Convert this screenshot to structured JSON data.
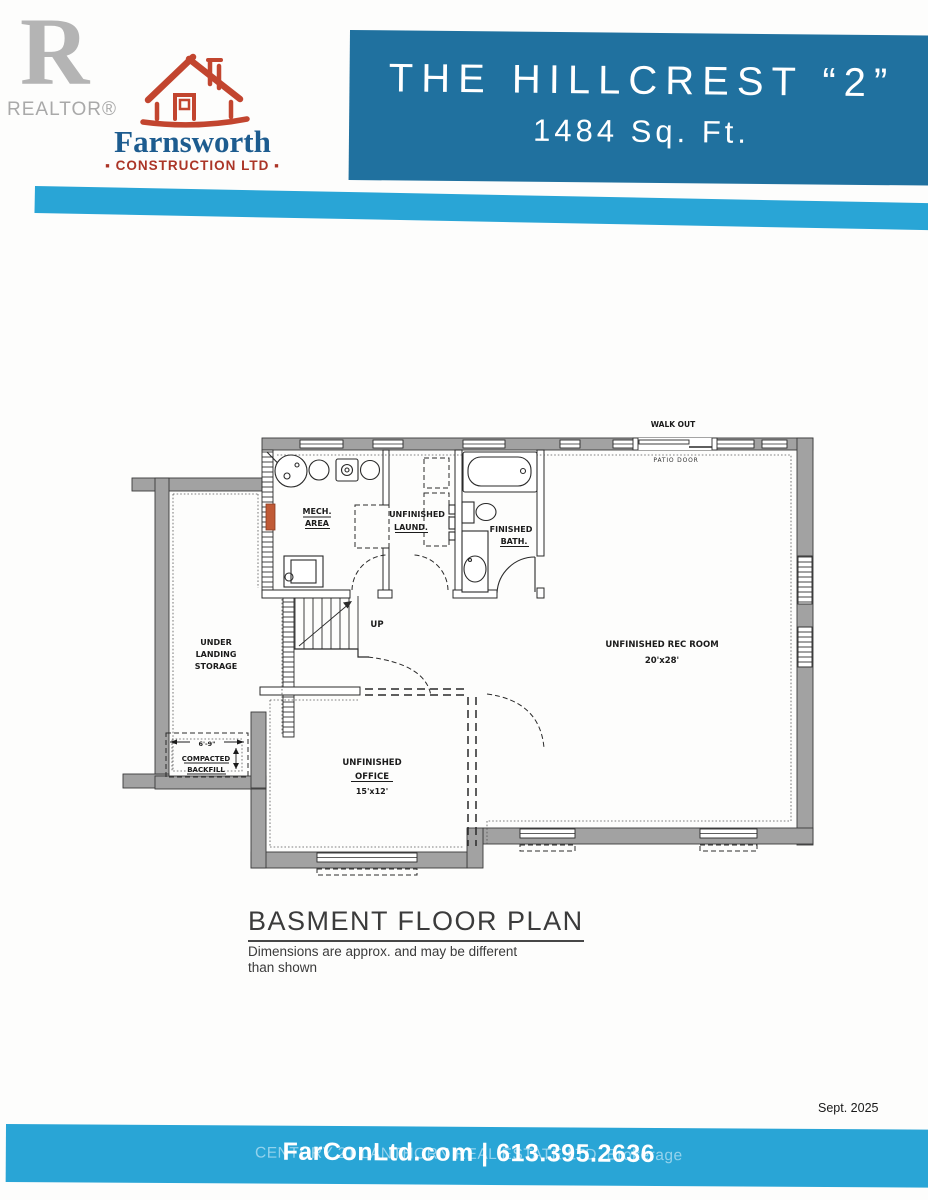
{
  "header": {
    "realtor_label": "REALTOR®",
    "realtor_letter": "R",
    "company": {
      "name": "Farnsworth",
      "subtitle": "▪ CONSTRUCTION LTD ▪"
    },
    "banner": {
      "title": "THE HILLCREST “2”",
      "subtitle": "1484 Sq. Ft."
    }
  },
  "plan": {
    "walk_out": "WALK OUT",
    "patio_door": "PATIO DOOR",
    "mech_line1": "MECH.",
    "mech_line2": "AREA",
    "laund_line1": "UNFINISHED",
    "laund_line2": "LAUND.",
    "bath_line1": "FINISHED",
    "bath_line2": "BATH.",
    "up": "UP",
    "storage_line1": "UNDER",
    "storage_line2": "LANDING",
    "storage_line3": "STORAGE",
    "backfill_dim": "6'-9\"",
    "backfill_line1": "COMPACTED",
    "backfill_line2": "BACKFILL",
    "office_line1": "UNFINISHED",
    "office_line2": "OFFICE",
    "office_dim": "15'x12'",
    "recroom_line1": "UNFINISHED REC ROOM",
    "recroom_dim": "20'x28'"
  },
  "title_block": {
    "title": "BASMENT FLOOR PLAN",
    "disclaimer_line1": "Dimensions are approx. and may be different",
    "disclaimer_line2": "than shown"
  },
  "footer": {
    "date": "Sept. 2025",
    "contact": "FarConLtd.com | 613.395.2636",
    "watermark": "CENTURY 21 LANTHORN REAL ESTATE LTD. Brokerage"
  },
  "colors": {
    "banner_blue": "#20719f",
    "stripe_blue": "#29a5d6",
    "logo_blue": "#1d5c8f",
    "logo_red": "#ab3527",
    "realtor_gray": "#b4b4b4",
    "wall_gray": "#a2a2a2",
    "marker_orange": "#c05a36"
  }
}
